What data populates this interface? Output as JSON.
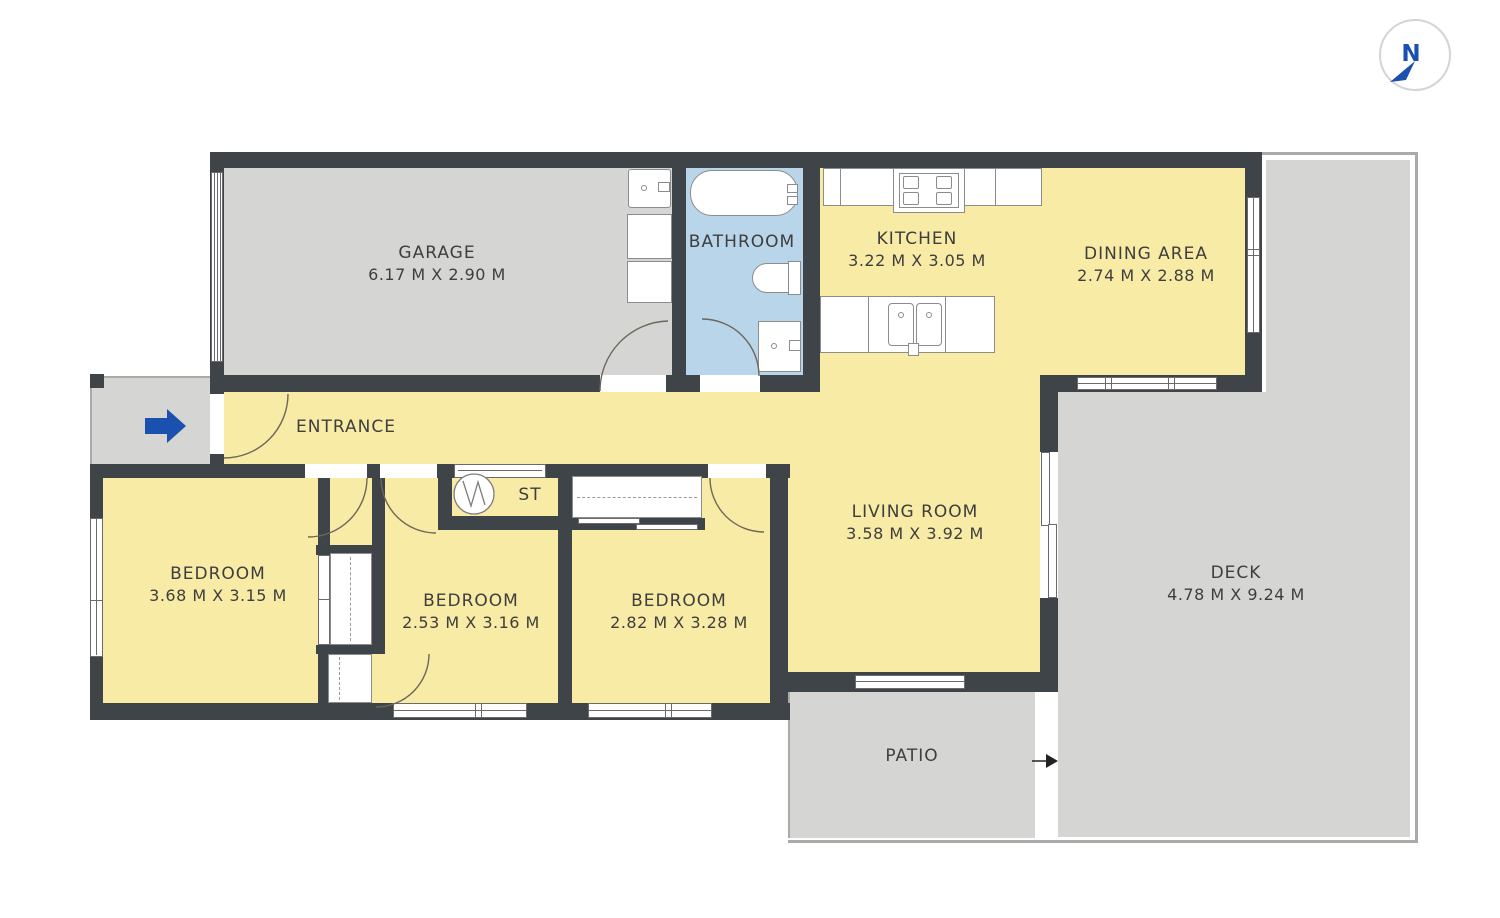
{
  "compass": {
    "north_label": "N"
  },
  "rooms": {
    "garage": {
      "name": "GARAGE",
      "dimensions": "6.17 M X 2.90 M"
    },
    "bathroom": {
      "name": "BATHROOM"
    },
    "kitchen": {
      "name": "KITCHEN",
      "dimensions": "3.22 M X 3.05 M"
    },
    "dining": {
      "name": "DINING AREA",
      "dimensions": "2.74 M X 2.88 M"
    },
    "entrance": {
      "name": "ENTRANCE"
    },
    "storage": {
      "name": "ST"
    },
    "bedroom1": {
      "name": "BEDROOM",
      "dimensions": "3.68 M X 3.15 M"
    },
    "bedroom2": {
      "name": "BEDROOM",
      "dimensions": "2.53 M X 3.16 M"
    },
    "bedroom3": {
      "name": "BEDROOM",
      "dimensions": "2.82 M X 3.28 M"
    },
    "living": {
      "name": "LIVING ROOM",
      "dimensions": "3.58 M X 3.92 M"
    },
    "deck": {
      "name": "DECK",
      "dimensions": "4.78 M X 9.24 M"
    },
    "patio": {
      "name": "PATIO"
    }
  },
  "icons": {
    "north_needle_icon": "compass needle pointing south-west",
    "entry_arrow_icon": "blue arrow pointing right into entrance",
    "patio_entry_arrow_icon": "black arrow pointing right from patio to deck",
    "water_heater_icon": "circle with zigzag (storage water heater)"
  },
  "colors": {
    "wall": "#3f4449",
    "indoor_floor": "#f8eba6",
    "outdoor_floor": "#d5d6d3",
    "bathroom_floor": "#b9d5e9",
    "accent_blue": "#1a51ae",
    "fixture_outline": "#8c8c8c"
  }
}
